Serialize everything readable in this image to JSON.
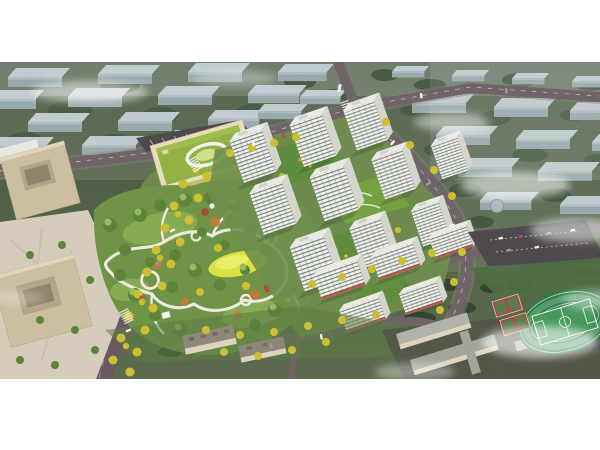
{
  "meta": {
    "alt": "Aerial rendering of a planned residential community: white high-rise apartment towers around green courtyards, a large landscaped central park with winding white paths and a yellow lawn, a kindergarten with a green roof, tan office buildings and plaza on the left, a tree-lined avenue with yellow autumn trees, retail streets, a school campus with a green running track and red sports courts at lower right, all surrounded by a faded existing city of slab buildings under drifting mist, framed by white margins top and bottom."
  },
  "scene": {
    "description": "Bird's-eye masterplan visualization of a residential development with central park, towers, kindergarten, offices, avenue, school and sports field, in a desaturated city context with mist.",
    "regions": [
      {
        "id": "background-city",
        "label": "Faded existing city blocks with trees and mist"
      },
      {
        "id": "road-network",
        "label": "Perimeter roads and tree-lined avenue"
      },
      {
        "id": "left-office-district",
        "label": "Tan office buildings and pedestrian plaza"
      },
      {
        "id": "kindergarten",
        "label": "Kindergarten with green roof and oval courtyard"
      },
      {
        "id": "central-park",
        "label": "Landscaped park with paths, lawn and pavilions"
      },
      {
        "id": "residential-towers",
        "label": "White apartment towers with green podium courtyards"
      },
      {
        "id": "retail-slabs",
        "label": "Mid-rise slabs with street-level shops"
      },
      {
        "id": "south-buildings",
        "label": "Low slab buildings along the south street"
      },
      {
        "id": "east-parking",
        "label": "Surface parking lot"
      },
      {
        "id": "school-campus",
        "label": "School buildings"
      },
      {
        "id": "sports-field",
        "label": "Running track, football pitch and red courts"
      },
      {
        "id": "mist-clouds",
        "label": "White mist drifting over the scene"
      }
    ]
  },
  "palette": {
    "white": "#f5f5f3",
    "band_top": "#43523b",
    "band_bottom": "#5c6b4e",
    "forest": "#34462e",
    "bg_roof": "#c4cfd7",
    "bg_side": "#93a5aa",
    "haze": "#d9e1db",
    "road": "#6f6569",
    "road_edge": "#87837a",
    "avenue": "#685a60",
    "path": "#edebe0",
    "plaza": "#d6ccbb",
    "office": "#cbbea1",
    "office_inner": "#b3a588",
    "park": "#6f9447",
    "park_light": "#8db457",
    "lawn": "#d9e240",
    "lawn_hi": "#eaf06d",
    "tree_dark": "#3a512f",
    "tree_mid": "#5d8439",
    "tree_light": "#9ab964",
    "tree_yellow": "#cdbf33",
    "tree_orange": "#c07a3a",
    "tree_red": "#a64e32",
    "tower_face": "#f3f4ef",
    "tower_side": "#d4d6cd",
    "tower_roof": "#e9eae3",
    "win": "#59635a",
    "shop_awning": "#a8443a",
    "courtyard": "#5f8d3d",
    "podium": "#76a143",
    "kinder_roof": "#93b244",
    "kinder_wall": "#e8dcba",
    "kinder_yard": "#d8d075",
    "parking": "#4e4a4e",
    "track": "#2f7d4a",
    "track_lane": "#5aa06e",
    "pitch": "#46985c",
    "court": "#b04a3e",
    "court_in": "#3f8a52",
    "school_roof": "#b2b2aa",
    "school_roof2": "#a4a49c",
    "school_wall": "#dcd4bf",
    "slab_roof_dark": "#8d8879",
    "mist": "#ffffff",
    "car_white": "#f2f2f2",
    "car_red": "#c0483c",
    "car_gray": "#9b9b9b"
  }
}
